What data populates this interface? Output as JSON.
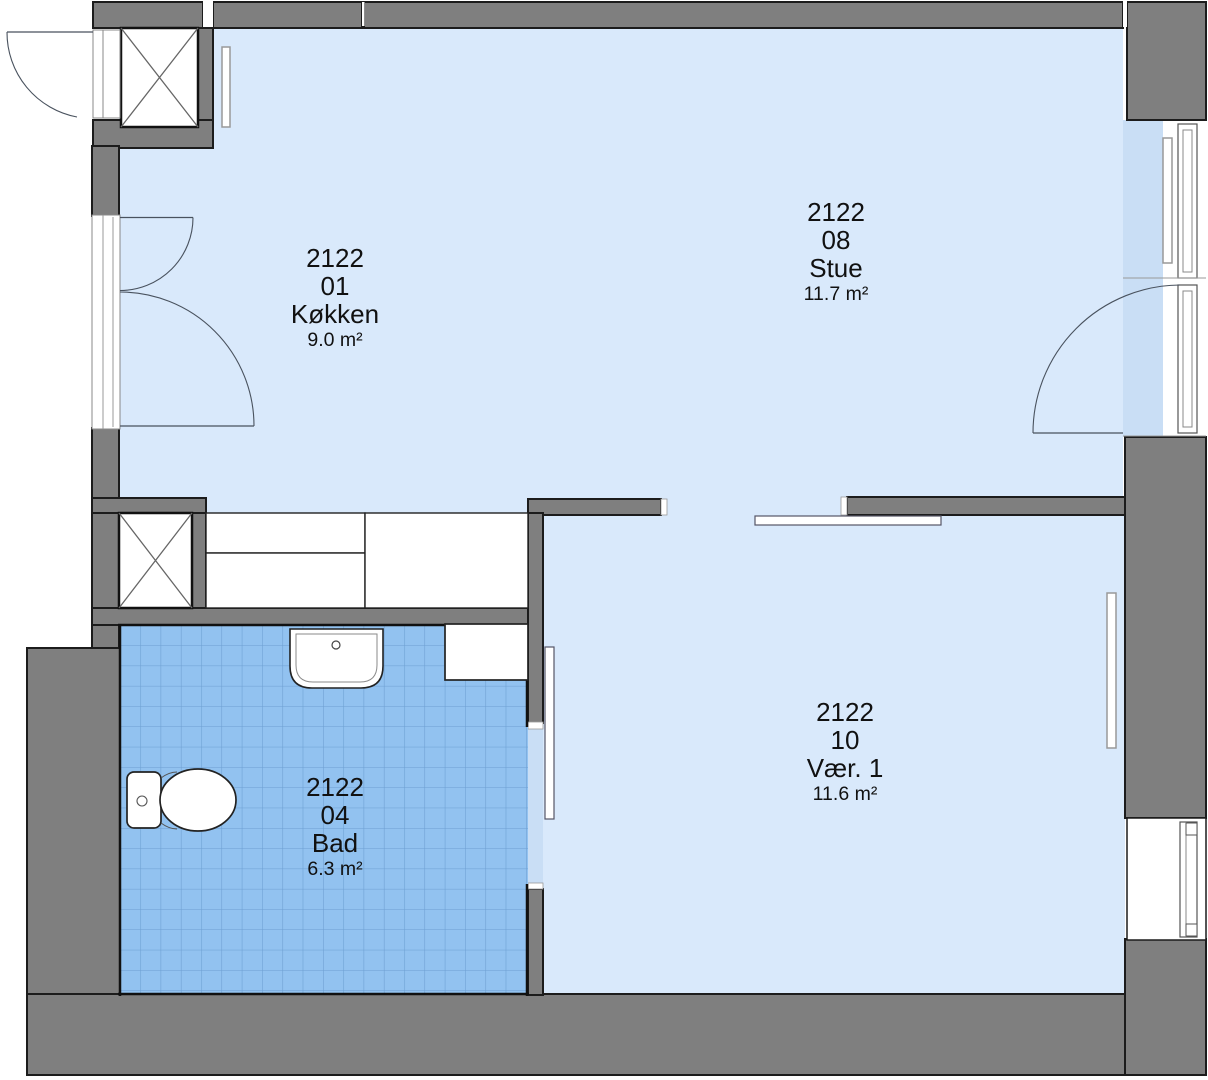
{
  "plan": {
    "title": "Apartment 2122 floor plan",
    "rooms": [
      {
        "id": "2122",
        "number": "01",
        "name": "Køkken",
        "area": "9.0 m²"
      },
      {
        "id": "2122",
        "number": "08",
        "name": "Stue",
        "area": "11.7 m²"
      },
      {
        "id": "2122",
        "number": "04",
        "name": "Bad",
        "area": "6.3 m²"
      },
      {
        "id": "2122",
        "number": "10",
        "name": "Vær. 1",
        "area": "11.6 m²"
      }
    ],
    "colors": {
      "wall": "#7f7f7f",
      "outline": "#1c1c1c",
      "room_fill": "#d9e9fb",
      "window_bay_fill": "#c9def5",
      "bathroom_tile": "#92c2f0",
      "bathroom_tile_line": "#6d9fd2",
      "fixture_line": "#49525e"
    }
  }
}
